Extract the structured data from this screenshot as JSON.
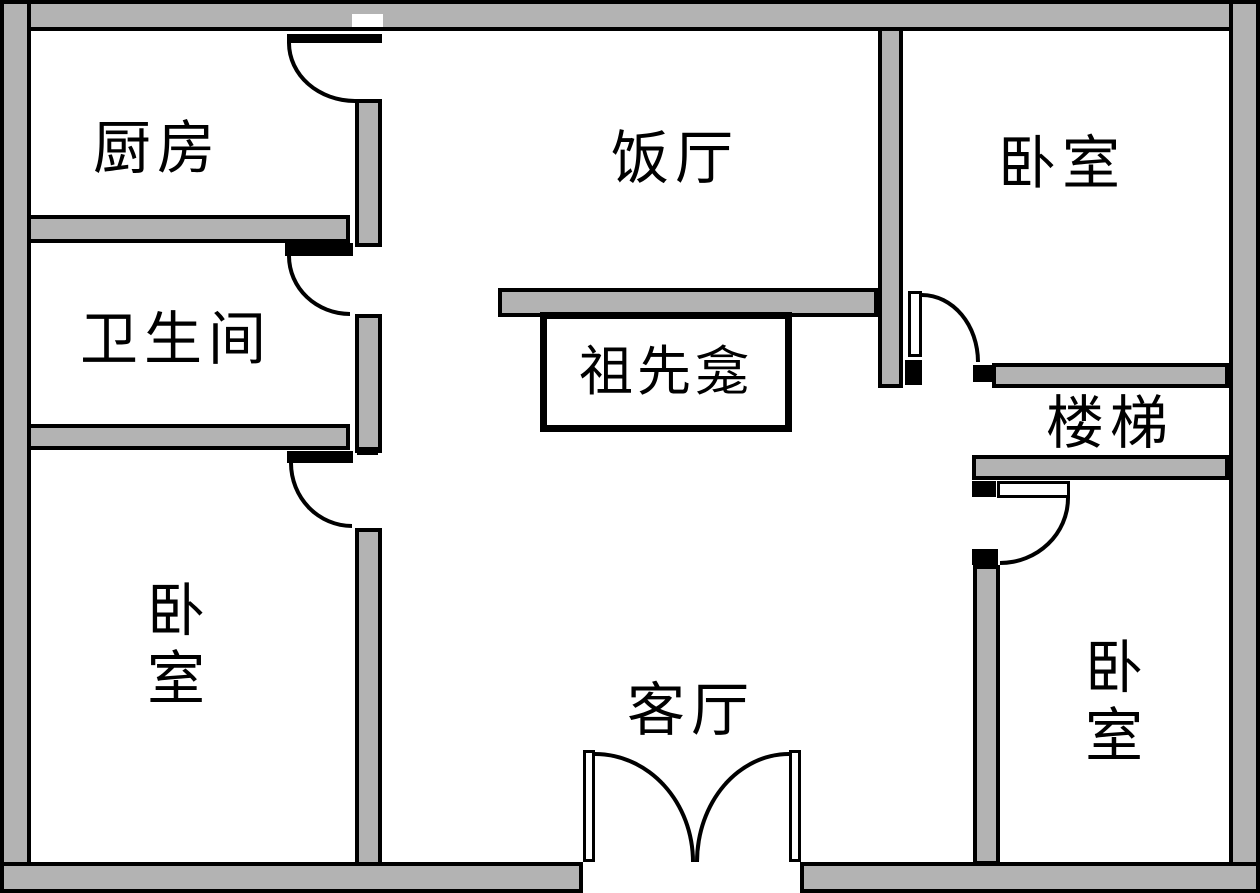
{
  "diagram_type": "apartment-floor-plan",
  "colors": {
    "wall_fill": "#b3b3b3",
    "line": "#000000",
    "background": "#ffffff"
  },
  "rooms": [
    {
      "id": "kitchen",
      "label": "厨房"
    },
    {
      "id": "dining_room",
      "label": "饭厅"
    },
    {
      "id": "bedroom_top_right",
      "label": "卧室"
    },
    {
      "id": "bathroom",
      "label": "卫生间"
    },
    {
      "id": "ancestor_shrine",
      "label": "祖先龛"
    },
    {
      "id": "stairs",
      "label": "楼梯"
    },
    {
      "id": "bedroom_bottom_left",
      "label": "卧室",
      "label_chars": [
        "卧",
        "室"
      ]
    },
    {
      "id": "living_room",
      "label": "客厅"
    },
    {
      "id": "bedroom_bottom_right",
      "label": "卧室",
      "label_chars": [
        "卧",
        "室"
      ]
    }
  ]
}
